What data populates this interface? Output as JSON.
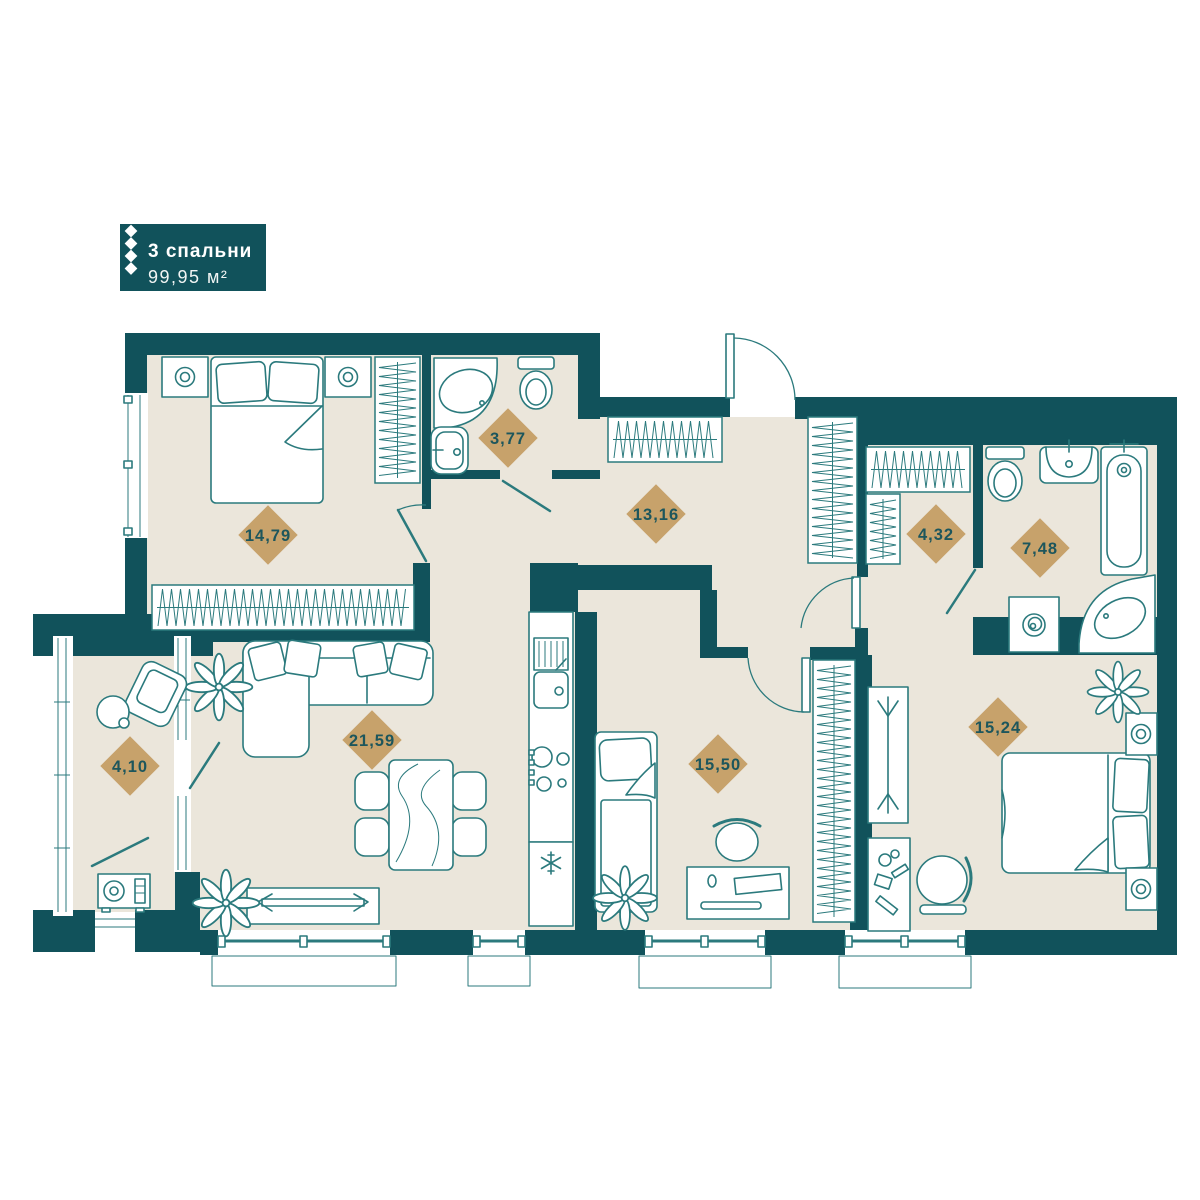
{
  "plan": {
    "badge": {
      "title": "3 спальни",
      "area": "99,95 м²"
    },
    "rooms": [
      {
        "id": "bedroom-1",
        "area": "14,79",
        "cx": 268,
        "cy": 535
      },
      {
        "id": "bathroom-small",
        "area": "3,77",
        "cx": 508,
        "cy": 438
      },
      {
        "id": "hallway",
        "area": "13,16",
        "cx": 656,
        "cy": 514
      },
      {
        "id": "wardrobe-room",
        "area": "4,32",
        "cx": 936,
        "cy": 534
      },
      {
        "id": "bathroom-big",
        "area": "7,48",
        "cx": 1040,
        "cy": 548
      },
      {
        "id": "balcony",
        "area": "4,10",
        "cx": 130,
        "cy": 766
      },
      {
        "id": "living-kitchen",
        "area": "21,59",
        "cx": 372,
        "cy": 740
      },
      {
        "id": "bedroom-2",
        "area": "15,50",
        "cx": 718,
        "cy": 764
      },
      {
        "id": "bedroom-3",
        "area": "15,24",
        "cx": 998,
        "cy": 727
      }
    ]
  },
  "colors": {
    "wall": "#11525b",
    "floor": "#ebe6db",
    "furniture_line": "#2b7a7d",
    "label_diamond": "#c7a26b",
    "label_text": "#1d565c",
    "badge_bg": "#11525b",
    "badge_text": "#ffffff"
  }
}
